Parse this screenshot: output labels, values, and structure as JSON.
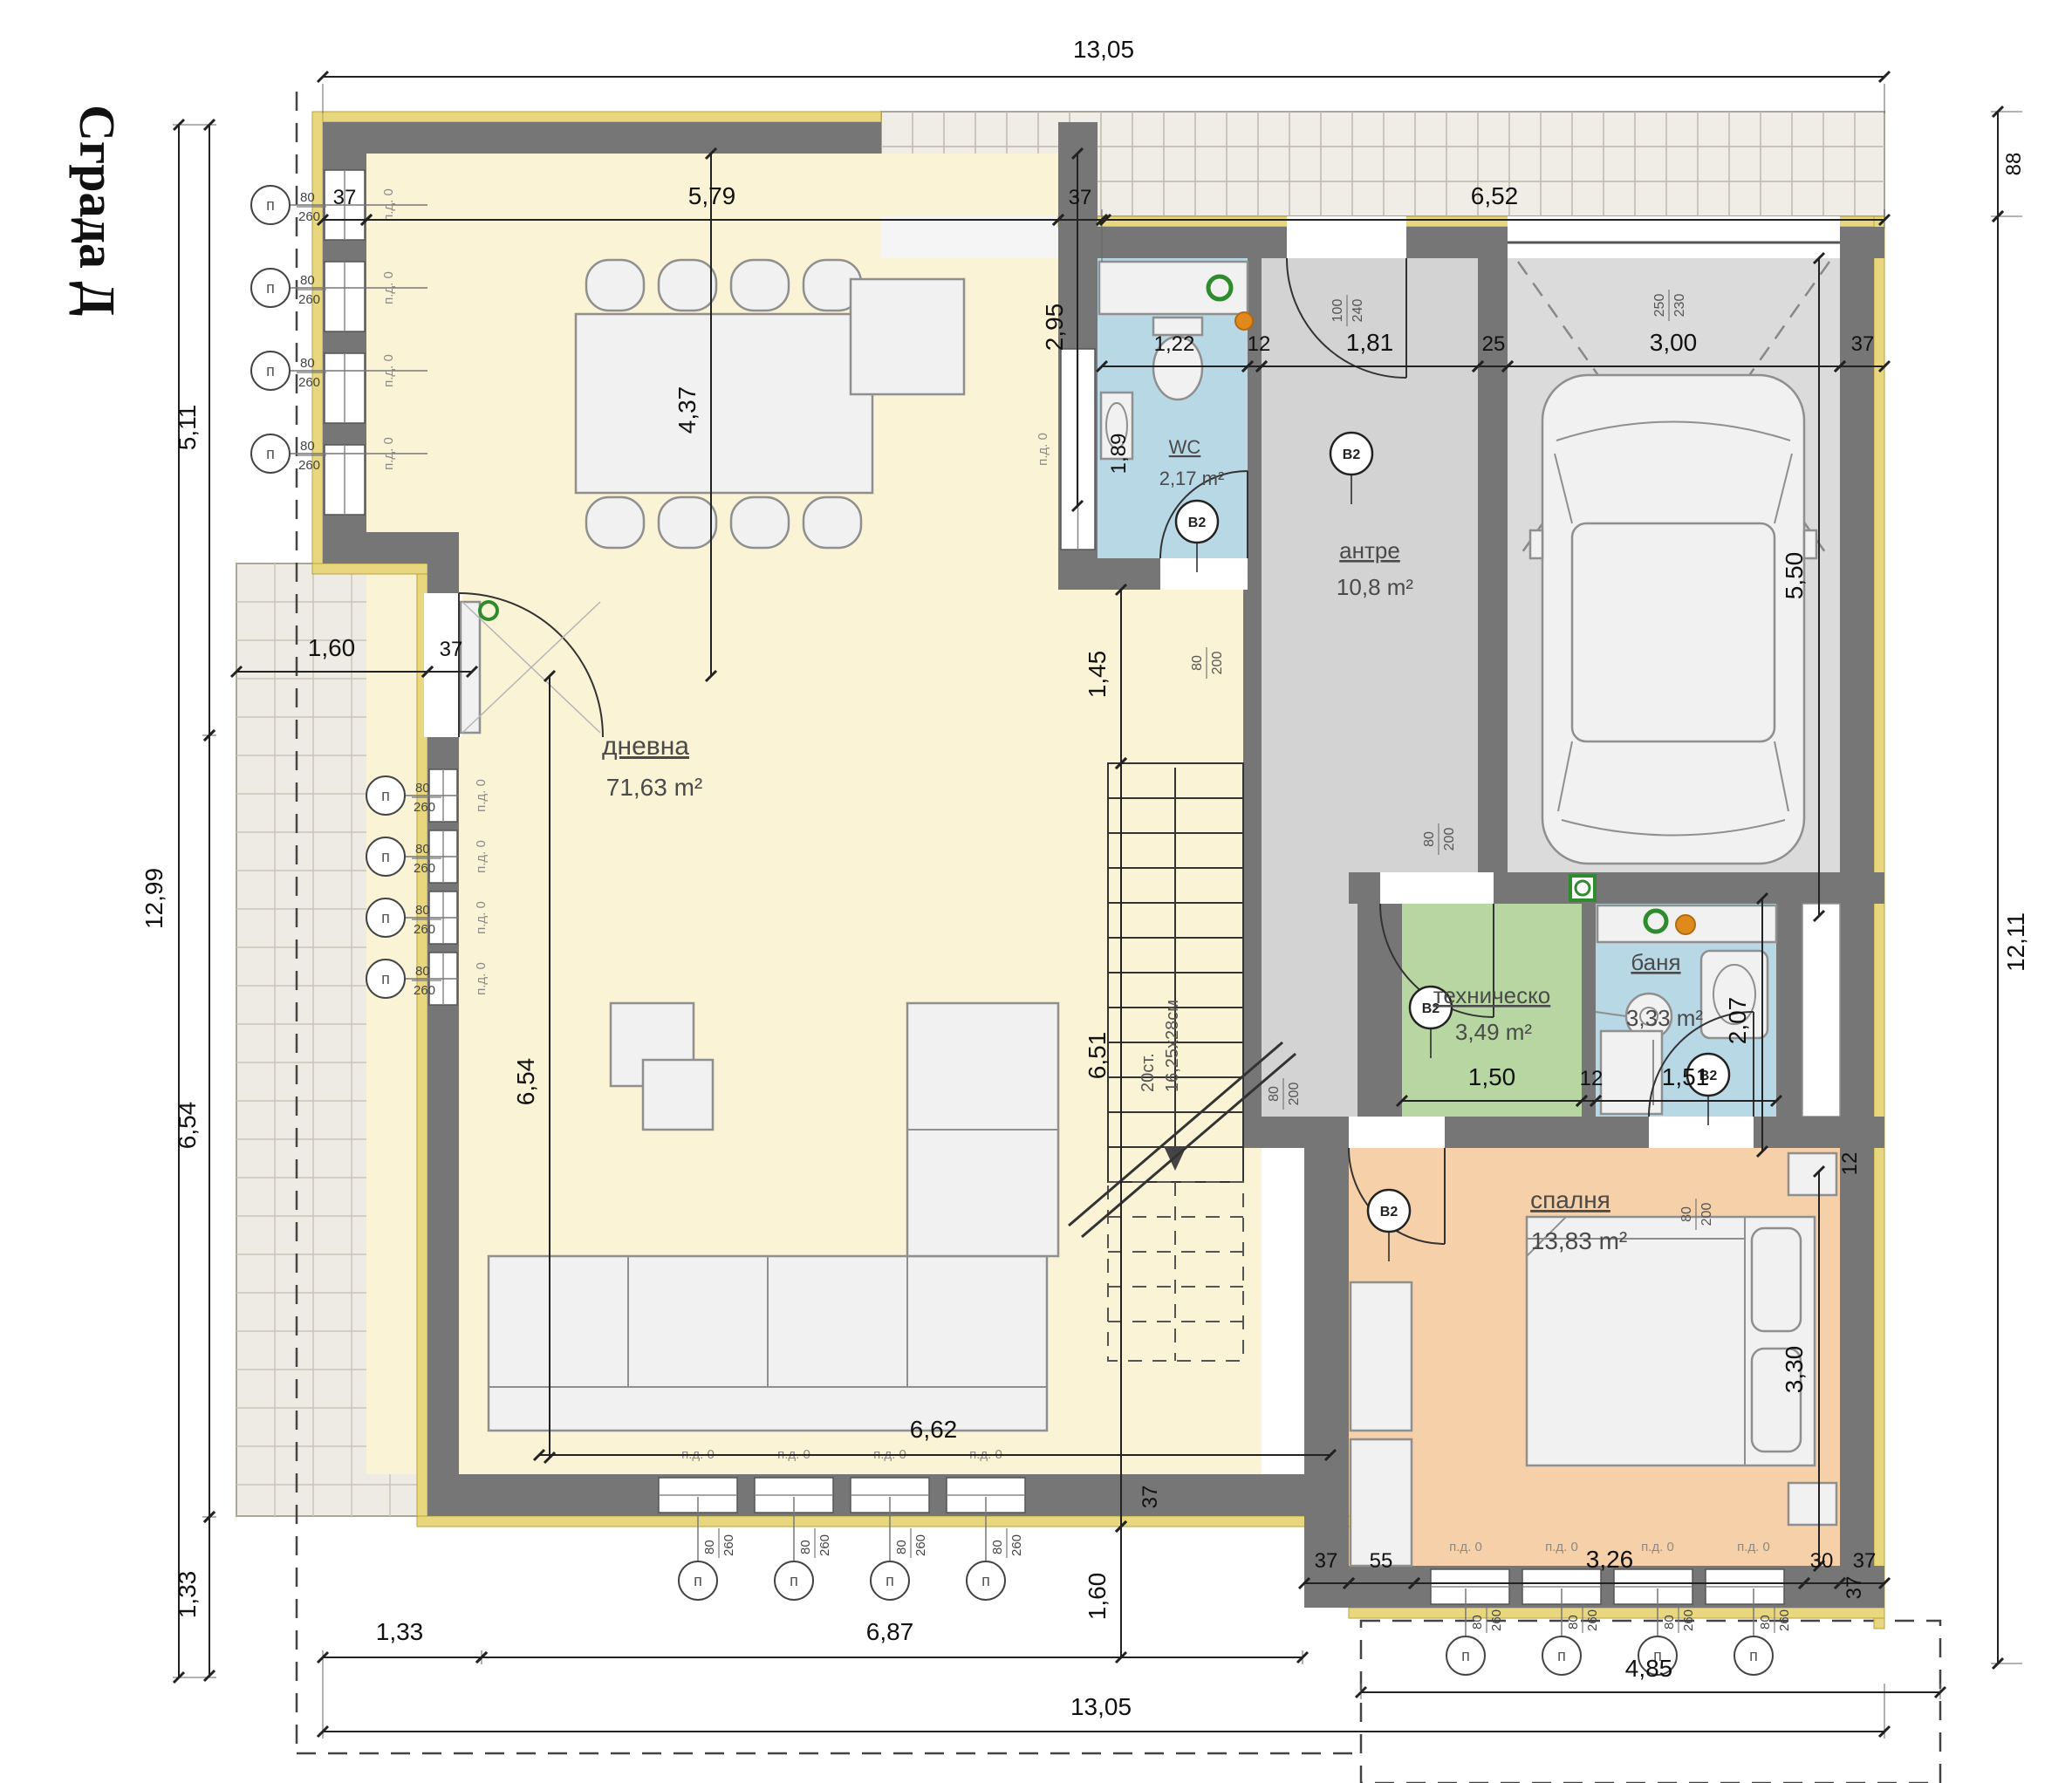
{
  "title": "Сграда Д",
  "rooms": {
    "living": {
      "name": "дневна",
      "area": "71,63 m²"
    },
    "wc": {
      "name": "WC",
      "area": "2,17 m²"
    },
    "hall": {
      "name": "антре",
      "area": "10,8 m²"
    },
    "tech": {
      "name": "техническо",
      "area": "3,49 m²"
    },
    "bath": {
      "name": "баня",
      "area": "3,33 m²"
    },
    "bedroom": {
      "name": "спалня",
      "area": "13,83 m²"
    }
  },
  "stairs": {
    "line1": "20ст.",
    "line2": "16,25х28см"
  },
  "labels": {
    "window_letter": "п",
    "window_w": "80",
    "window_h": "260",
    "pd0": "п.д. 0",
    "b2": "В2"
  },
  "doors": {
    "entrance": {
      "w": "100",
      "h": "240"
    },
    "garage": {
      "w": "250",
      "h": "230"
    },
    "standard": {
      "w": "80",
      "h": "200"
    }
  },
  "dims": {
    "t1305": "13,05",
    "t37a": "37",
    "t579": "5,79",
    "t37b": "37",
    "t652": "6,52",
    "r88": "88",
    "r1211": "12,11",
    "g550": "5,50",
    "c122": "1,22",
    "c12": "12",
    "c181": "1,81",
    "c25": "25",
    "c300": "3,00",
    "c37": "37",
    "v295": "2,95",
    "v189": "1,89",
    "v145": "1,45",
    "v651": "6,51",
    "v437": "4,37",
    "v654i": "6,54",
    "h662": "6,62",
    "h160": "1,60",
    "h37t": "37",
    "l1299": "12,99",
    "l511": "5,11",
    "l654": "6,54",
    "l133": "1,33",
    "b133": "1,33",
    "b687": "6,87",
    "b485": "4,85",
    "b1305": "13,05",
    "v160": "1,60",
    "s37a": "37",
    "s55": "55",
    "s326": "3,26",
    "s30": "30",
    "s37b": "37",
    "v330": "3,30",
    "v207": "2,07",
    "p150": "1,50",
    "p12": "12",
    "p151": "1,51",
    "ne12": "12",
    "se37": "37",
    "sw37": "37"
  },
  "colors": {
    "insulation": "#e8d77e",
    "wall": "#767676",
    "living": "#faf3d5",
    "wet": "#b9d8e6",
    "hall": "#d3d3d3",
    "garage": "#dbdbdb",
    "tech": "#b7d6a2",
    "bedroom": "#f6d0a8",
    "green_marker": "#2e8b2e",
    "orange_marker": "#e08a1e"
  }
}
